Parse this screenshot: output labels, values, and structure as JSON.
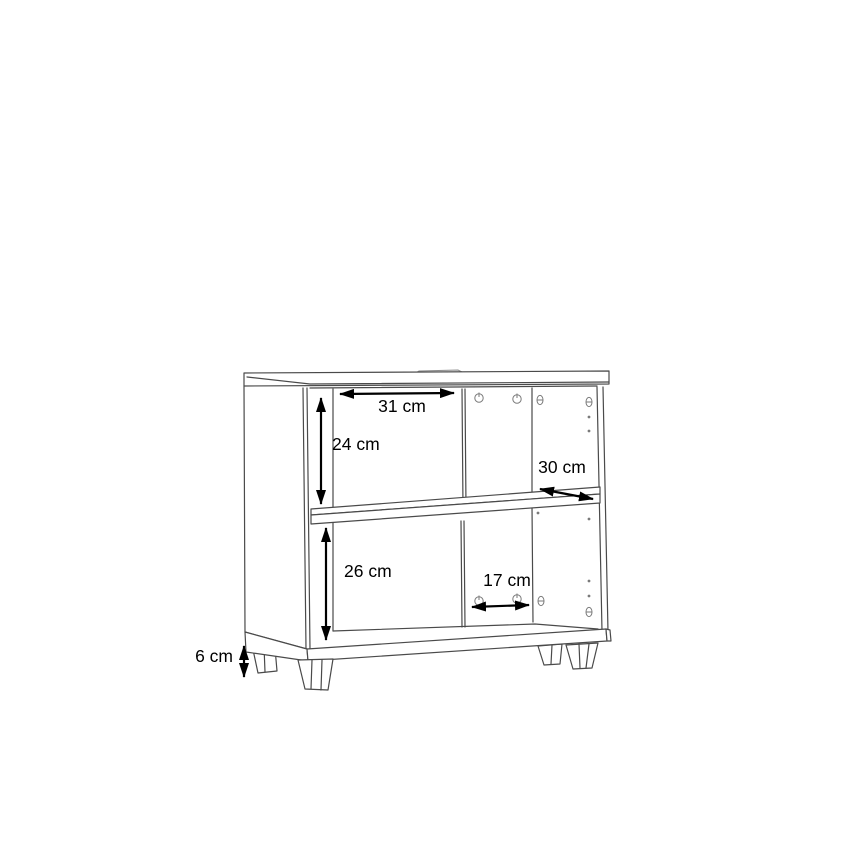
{
  "diagram": {
    "colors": {
      "background": "#ffffff",
      "cabinet_line": "#4a4a4a",
      "annotation": "#000000"
    },
    "labels": {
      "top_inner_width": "31 cm",
      "top_compartment_height": "24 cm",
      "shelf_depth": "30 cm",
      "bottom_compartment_height": "26 cm",
      "right_compartment_width": "17 cm",
      "leg_height": "6 cm"
    }
  }
}
